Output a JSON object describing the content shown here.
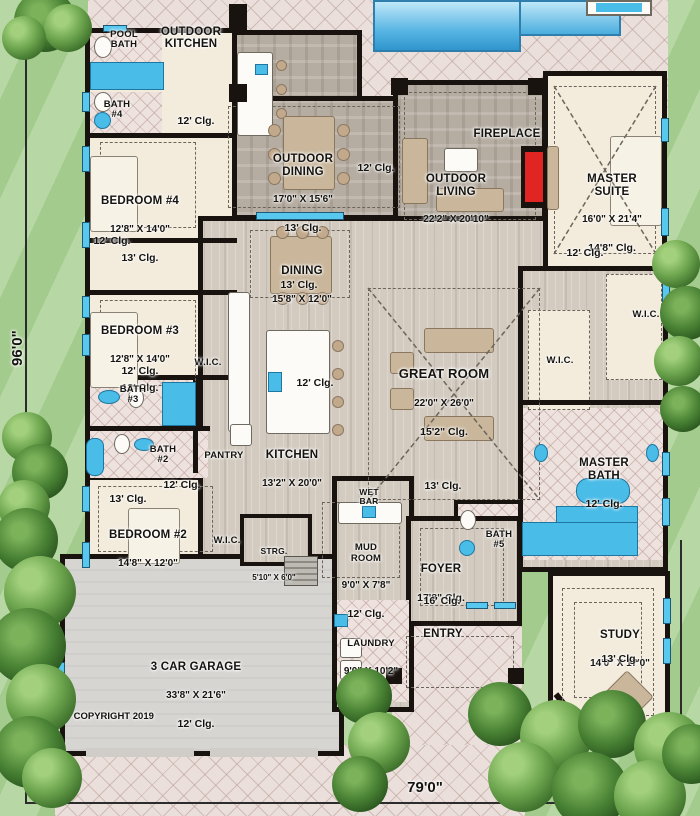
{
  "plan": {
    "lot_width": "79'0\"",
    "lot_depth": "96'0\"",
    "copyright": "© COPYRIGHT 2019"
  },
  "rooms": {
    "pool_bath": {
      "name": "POOL\nBATH"
    },
    "outdoor_kitchen": {
      "name": "OUTDOOR\nKITCHEN"
    },
    "bath4": {
      "name": "BATH\n#4"
    },
    "bedroom4": {
      "name": "BEDROOM #4",
      "dims": "12'8\" X 14'0\"",
      "clg": "13' Clg."
    },
    "outdoor_dining": {
      "name": "OUTDOOR\nDINING",
      "dims": "17'0\" X 15'6\"",
      "clg": "13' Clg."
    },
    "outdoor_living": {
      "name": "OUTDOOR\nLIVING",
      "dims": "22'2\" X 20'10\""
    },
    "fireplace": {
      "name": "FIREPLACE"
    },
    "master_suite": {
      "name": "MASTER\nSUITE",
      "dims": "16'0\" X 21'4\"",
      "clg": "14'8\" Clg."
    },
    "dining": {
      "name": "DINING",
      "dims": "15'8\" X 12'0\""
    },
    "bedroom3": {
      "name": "BEDROOM #3",
      "dims": "12'8\" X 14'0\"",
      "clg": "13' Clg."
    },
    "great_room": {
      "name": "GREAT ROOM",
      "dims": "22'0\" X 26'0\"",
      "clg": "15'2\" Clg."
    },
    "kitchen": {
      "name": "KITCHEN",
      "dims": "13'2\" X 20'0\""
    },
    "pantry": {
      "name": "PANTRY"
    },
    "bath3": {
      "name": "BATH\n#3"
    },
    "bath2": {
      "name": "BATH\n#2"
    },
    "master_bath": {
      "name": "MASTER\nBATH",
      "clg": "12' Clg."
    },
    "bedroom2": {
      "name": "BEDROOM #2",
      "dims": "14'8\" X 12'0\""
    },
    "wet_bar": {
      "name": "WET\nBAR"
    },
    "wic": {
      "name": "W.I.C."
    },
    "strg": {
      "name": "STRG.",
      "dims": "5'10\" X 6'0\""
    },
    "mud_room": {
      "name": "MUD\nROOM",
      "dims": "9'0\" X 7'8\"",
      "clg": "12' Clg."
    },
    "foyer": {
      "name": "FOYER",
      "clg": "17'8\" Clg."
    },
    "bath5": {
      "name": "BATH\n#5"
    },
    "garage": {
      "name": "3 CAR GARAGE",
      "dims": "33'8\" X 21'6\"",
      "clg": "12' Clg."
    },
    "laundry": {
      "name": "LAUNDRY",
      "dims": "9'0\" X 10'2\"",
      "clg": "12' Clg."
    },
    "entry": {
      "name": "ENTRY"
    },
    "study": {
      "name": "STUDY",
      "dims": "14'0\" X 17'0\"",
      "clg": "13' Clg."
    }
  },
  "ceiling_notes": {
    "outdoor_kitchen": "12' Clg.",
    "outdoor_patio": "12' Clg.",
    "hall_bed4": "12' Clg.",
    "hall_bed3": "12' Clg.",
    "dining": "13' Clg.",
    "kitchen": "12' Clg.",
    "great_room": "13' Clg.",
    "master_suite": "12' Clg.",
    "bedroom2_hall": "12' Clg.",
    "bedroom2": "13' Clg.",
    "foyer_entry": "16' Clg.",
    "study": "13' Clg."
  },
  "colors": {
    "wall": "#18130f",
    "grass": "#abd295",
    "pool": "#57b5e4",
    "window": "#58c8ee",
    "fireplace": "#e02522",
    "patio_tile": "#eadfdb",
    "stone": "#b6ada2"
  }
}
